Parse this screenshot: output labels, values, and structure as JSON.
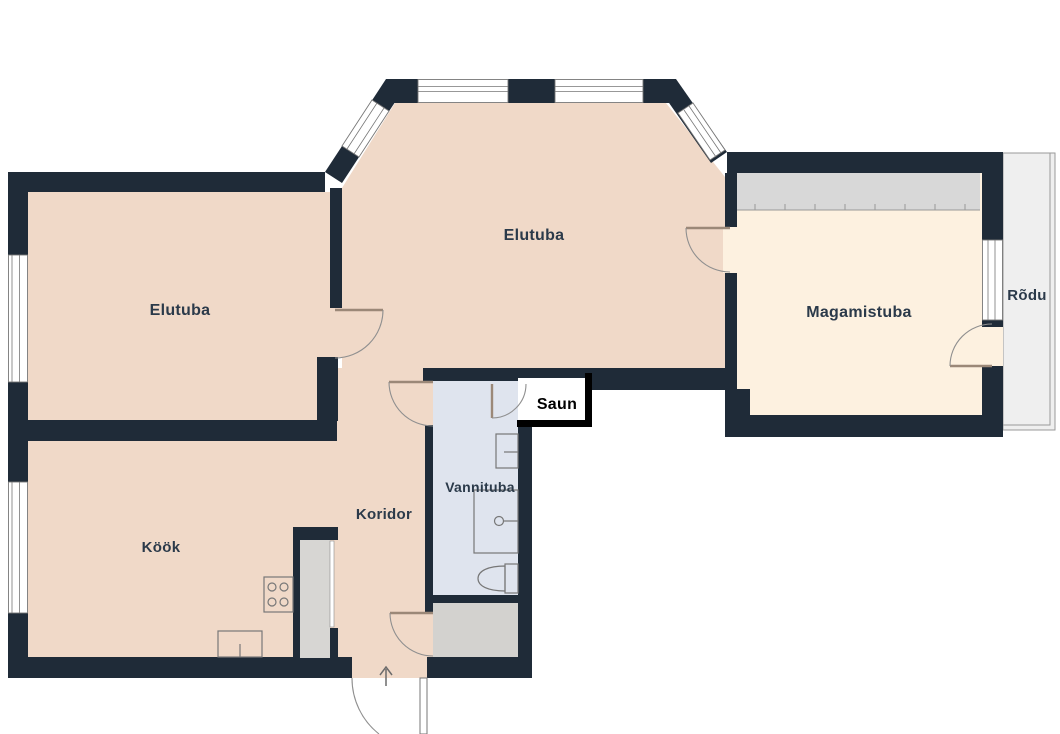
{
  "plan": {
    "type": "apartment-floor-plan",
    "rooms": {
      "living_room_main": {
        "label": "Elutuba"
      },
      "living_room_left": {
        "label": "Elutuba"
      },
      "bedroom": {
        "label": "Magamistuba"
      },
      "balcony": {
        "label": "Rõdu"
      },
      "sauna": {
        "label": "Saun"
      },
      "bathroom": {
        "label": "Vannituba"
      },
      "corridor": {
        "label": "Koridor"
      },
      "kitchen": {
        "label": "Köök"
      }
    },
    "fixtures": {
      "stove": "stove-icon",
      "kitchen_sink": "kitchen-sink-icon",
      "vent_shaft": "vent-shaft-icon",
      "washbasin": "washbasin-icon",
      "shower": "shower-icon",
      "toilet": "toilet-icon",
      "wardrobe": "wardrobe-icon",
      "entrance_arrow": "entrance-arrow-icon"
    },
    "colors": {
      "wall": "#1f2b38",
      "floor_living": "#f0d9c8",
      "floor_bedroom": "#fdf1e0",
      "floor_bathroom": "#dfe4ee",
      "floor_storage": "#d3d2cf",
      "floor_balcony": "#efefef",
      "floor_sauna": "#ffffff",
      "wardrobe": "#d8d8d8",
      "sauna_border": "#000000",
      "label": "#2b3a4a",
      "door": "#9b8878",
      "fixture": "#777777"
    }
  }
}
